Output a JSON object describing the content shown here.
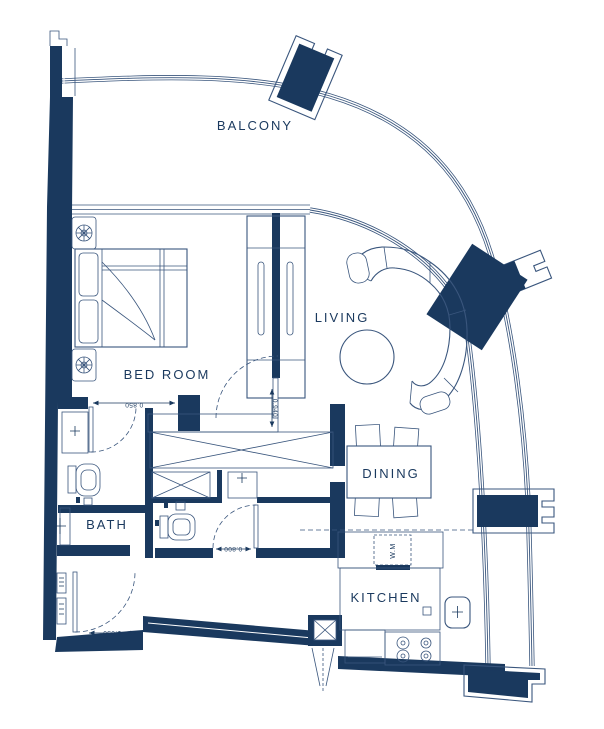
{
  "colors": {
    "wall": "#1a395e",
    "line": "#3a567d",
    "bg": "#ffffff"
  },
  "labels": {
    "balcony": "BALCONY",
    "bedroom": "BED ROOM",
    "living": "LIVING",
    "dining": "DINING",
    "bath": "BATH",
    "kitchen": "KITCHEN",
    "washing_machine": "W.M"
  },
  "dimensions": {
    "bedroom_entry_door": "0.850",
    "living_door": "0.940",
    "bathroom2_door": "0.800",
    "entry_door": "1.050"
  }
}
